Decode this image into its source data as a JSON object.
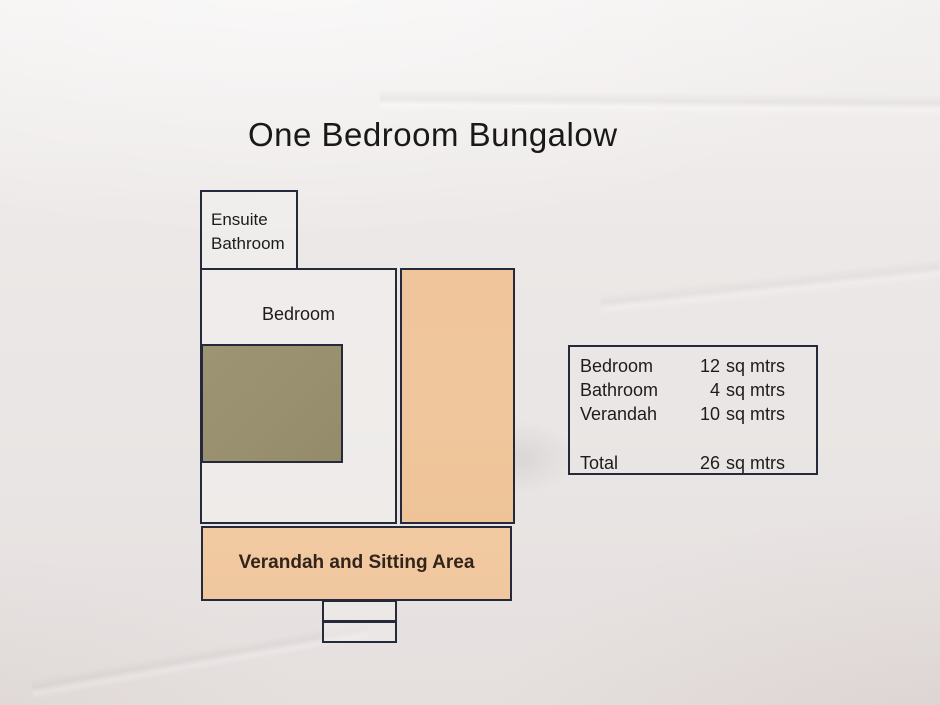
{
  "title": "One Bedroom Bungalow",
  "plan": {
    "ensuite": {
      "label": "Ensuite Bathroom"
    },
    "bedroom": {
      "label": "Bedroom"
    },
    "verandah": {
      "label": "Verandah and Sitting Area"
    }
  },
  "legend": {
    "rows": [
      {
        "label": "Bedroom",
        "qty": "12",
        "unit": "sq mtrs"
      },
      {
        "label": "Bathroom",
        "qty": "4",
        "unit": "sq mtrs"
      },
      {
        "label": "Verandah",
        "qty": "10",
        "unit": "sq mtrs"
      }
    ],
    "total": {
      "label": "Total",
      "qty": "26",
      "unit": "sq mtrs"
    }
  },
  "colors": {
    "paper": "#ebe7e6",
    "ink": "#242a3a",
    "olive": "#99906f",
    "orange": "#f0c69c",
    "verandah_orange": "#f1c9a0",
    "text": "#1e1c1b"
  }
}
